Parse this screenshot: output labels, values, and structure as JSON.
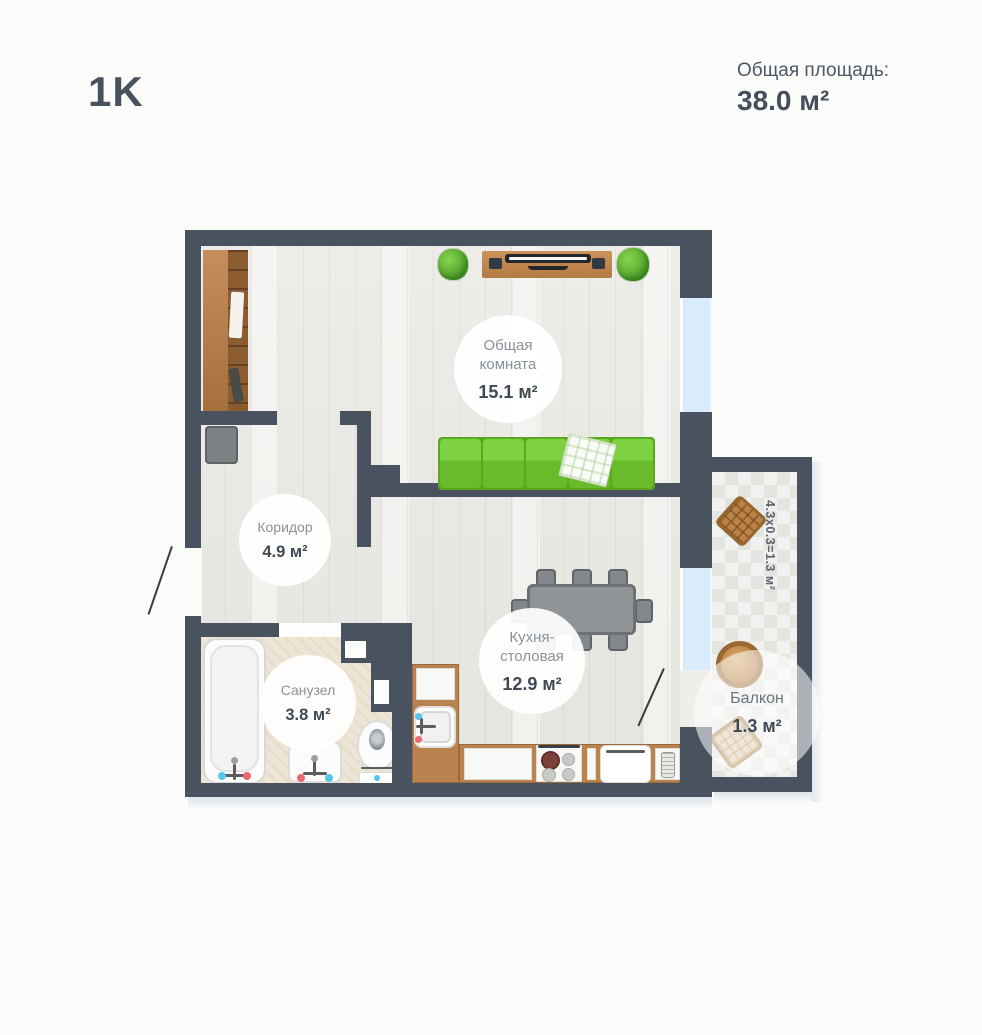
{
  "header": {
    "plan_type": "1K",
    "total_area_label": "Общая площадь:",
    "total_area_value": "38.0 м²"
  },
  "rooms": {
    "living": {
      "name": "Общая комната",
      "area": "15.1 м²"
    },
    "corridor": {
      "name": "Коридор",
      "area": "4.9 м²"
    },
    "bathroom": {
      "name": "Санузел",
      "area": "3.8 м²"
    },
    "kitchen": {
      "name": "Кухня-столовая",
      "area": "12.9 м²"
    },
    "balcony": {
      "name": "Балкон",
      "area": "1.3 м²",
      "dimension_note": "4.3x0.3=1.3 м²"
    }
  },
  "colors": {
    "wall": "#48535f",
    "text_dark": "#454f5b",
    "room_label_text": "#8a9199",
    "sofa_green": "#6fbf31",
    "furniture_wood": "#b9834f",
    "window_glass": "#d9ecfb",
    "bath_floor": "#ede5d5"
  }
}
